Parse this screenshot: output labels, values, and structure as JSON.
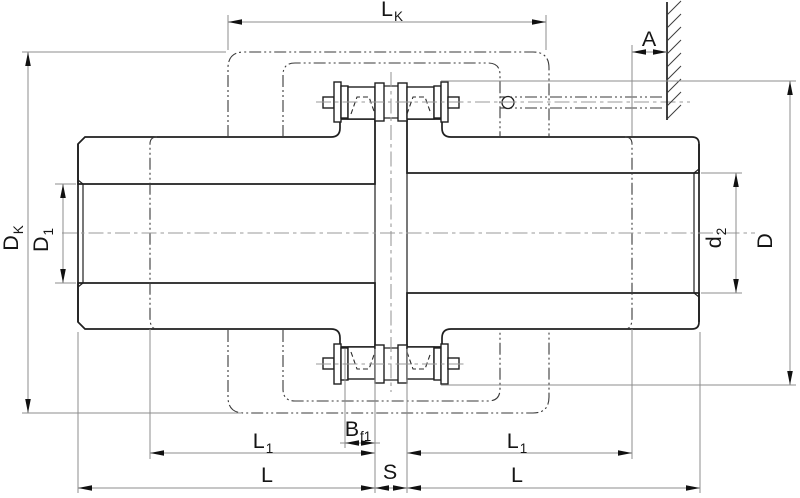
{
  "dims": {
    "lk": {
      "base": "L",
      "sub": "K"
    },
    "a": {
      "base": "A",
      "sub": ""
    },
    "dk": {
      "base": "D",
      "sub": "K"
    },
    "d1": {
      "base": "D",
      "sub": "1"
    },
    "d2": {
      "base": "d",
      "sub": "2"
    },
    "d_outer": {
      "base": "D",
      "sub": ""
    },
    "l1_left": {
      "base": "L",
      "sub": "1"
    },
    "l1_right": {
      "base": "L",
      "sub": "1"
    },
    "bf1": {
      "base": "B",
      "sub": "f1"
    },
    "s": {
      "base": "S",
      "sub": ""
    },
    "l_left": {
      "base": "L",
      "sub": ""
    },
    "l_right": {
      "base": "L",
      "sub": ""
    }
  },
  "colors": {
    "object_line": "#1f1f1f",
    "thin_line": "#8c8c8c",
    "phantom_line": "#3a3a3a",
    "background": "#ffffff"
  }
}
